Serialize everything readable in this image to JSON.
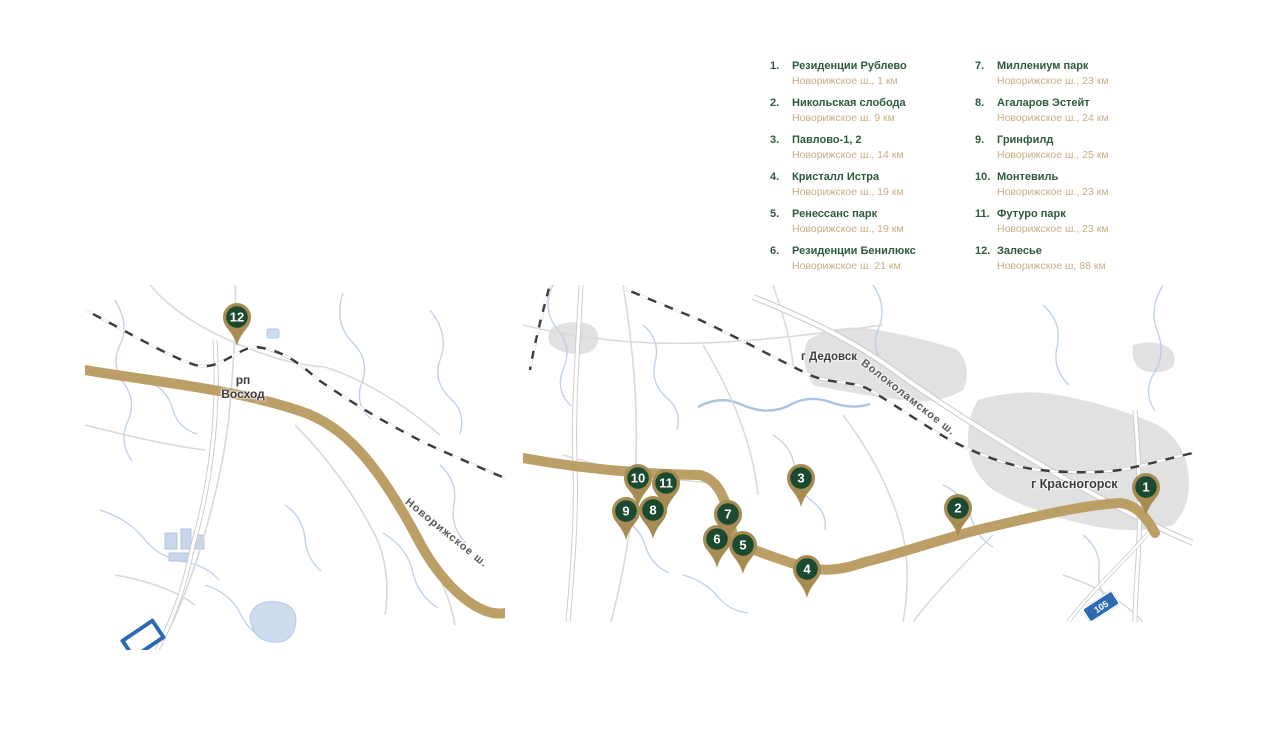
{
  "colors": {
    "legend_green": "#2d5a3d",
    "legend_tan": "#c8ad83",
    "marker_green": "#1c4a31",
    "marker_tan": "#a68c52",
    "highway_tan": "#bb9f66",
    "water": "#b5cbe8",
    "shield_blue": "#2e6ab2"
  },
  "legend": {
    "columns": [
      {
        "items": [
          {
            "num": "1.",
            "name": "Резиденции Рублево",
            "distance": "Новорижское ш., 1 км"
          },
          {
            "num": "2.",
            "name": "Никольская слобода",
            "distance": "Новорижское ш. 9 км"
          },
          {
            "num": "3.",
            "name": "Павлово-1, 2",
            "distance": "Новорижское ш., 14 км"
          },
          {
            "num": "4.",
            "name": "Кристалл Истра",
            "distance": "Новорижское ш., 19 км"
          },
          {
            "num": "5.",
            "name": "Ренессанс парк",
            "distance": "Новорижское ш., 19 км"
          },
          {
            "num": "6.",
            "name": "Резиденции Бенилюкс",
            "distance": "Новорижское ш. 21 км"
          }
        ]
      },
      {
        "items": [
          {
            "num": "7.",
            "name": "Миллениум парк",
            "distance": "Новорижское ш., 23 км"
          },
          {
            "num": "8.",
            "name": "Агаларов Эстейт",
            "distance": "Новорижское ш., 24 км"
          },
          {
            "num": "9.",
            "name": "Гринфилд",
            "distance": "Новорижское ш., 25 км"
          },
          {
            "num": "10.",
            "name": "Монтевиль",
            "distance": "Новорижское ш., 23 км"
          },
          {
            "num": "11.",
            "name": "Футуро парк",
            "distance": "Новорижское ш., 23 км"
          },
          {
            "num": "12.",
            "name": "Залесье",
            "distance": "Новорижское ш, 88 км"
          }
        ]
      }
    ]
  },
  "maps": {
    "left": {
      "town_prefix": "рп",
      "town_name": "Восход",
      "highway_label": "Новорижское ш.",
      "markers": [
        {
          "num": "12",
          "x": 152,
          "y": 32
        }
      ]
    },
    "right": {
      "town_dedovsk": "г Дедовск",
      "town_krasnogorsk": "г Красногорск",
      "road_label": "Волоколамское ш.",
      "road_shield": "105",
      "markers": [
        {
          "num": "3",
          "x": 278,
          "y": 193
        },
        {
          "num": "4",
          "x": 284,
          "y": 284
        },
        {
          "num": "2",
          "x": 435,
          "y": 223
        },
        {
          "num": "1",
          "x": 623,
          "y": 202
        },
        {
          "num": "11",
          "x": 143,
          "y": 198
        },
        {
          "num": "10",
          "x": 115,
          "y": 193
        },
        {
          "num": "9",
          "x": 103,
          "y": 226
        },
        {
          "num": "8",
          "x": 130,
          "y": 225
        },
        {
          "num": "7",
          "x": 205,
          "y": 229
        },
        {
          "num": "6",
          "x": 194,
          "y": 254
        },
        {
          "num": "5",
          "x": 220,
          "y": 260
        }
      ]
    }
  }
}
